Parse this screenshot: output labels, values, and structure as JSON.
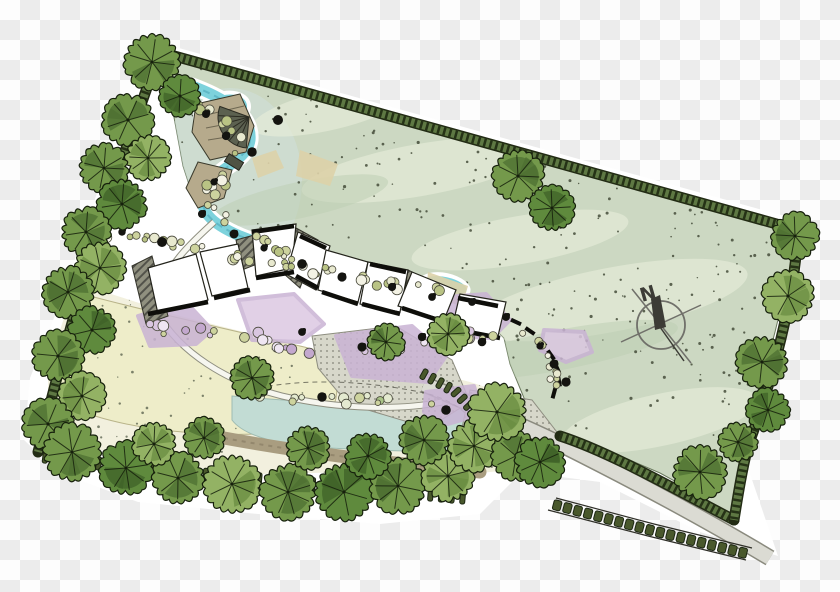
{
  "compass": {
    "label": "N",
    "cx": 661,
    "cy": 325,
    "r": 24,
    "needle": [
      651,
      299,
      660,
      295,
      666,
      327,
      655,
      330
    ],
    "tail": [
      660,
      327,
      684,
      361
    ],
    "cross1": [
      621,
      342,
      701,
      305
    ],
    "cross2": [
      632,
      289,
      691,
      363
    ]
  },
  "palette": {
    "lawn": "#ccd8c2",
    "lawn_wash": "#e7edd9",
    "lawn_wash2": "#bccdb2",
    "speckle": "#3c4431",
    "inner": "#f2f0de",
    "field": "#eeedc9",
    "pond": "#c2dcd4",
    "stream": "#7dd2dc",
    "stream_dark": "#57b2c0",
    "tan": "#b6aa8c",
    "berm": "#a99d80",
    "road_fill": "#dbdbd3",
    "road_edge": "#8a8a7e",
    "band_dark": "#222b14",
    "band_mid": "#5e7843",
    "band_hatch": "#1f2a12",
    "purple": "#c9b3d4",
    "purple_light": "#dcc8e2",
    "wall": "#0e0e0a",
    "building": "#ffffff",
    "building_line": "#23231b",
    "deck": "#5c6150",
    "bridge": "#4f5344",
    "tie_fill": "#49582c",
    "tie_line": "#1c2613",
    "tree_mid": [
      "#74994b",
      "#4d7031"
    ],
    "tree_light": [
      "#93b264",
      "#6a8c42"
    ],
    "tree_dark": [
      "#5f8a3d",
      "#3f6128"
    ],
    "tree_outline": "#16200c",
    "shrub_stroke": "#4a4a3c",
    "blob": "#141410",
    "compass_line": "#70706a",
    "compass_dark": "#3c3c36"
  },
  "halo_path": "M150,40 L806,222 L800,272 L780,342 L760,412 L746,462 L778,556 L700,532 L600,482 L522,472 L480,514 L380,524 L258,514 L138,502 L58,472 L24,440 L30,378 L62,298 L102,178 L140,78 Z",
  "lawn_poly": [
    [
      165,
      55
    ],
    [
      798,
      230
    ],
    [
      792,
      262
    ],
    [
      775,
      332
    ],
    [
      757,
      400
    ],
    [
      744,
      448
    ],
    [
      736,
      492
    ],
    [
      732,
      518
    ],
    [
      702,
      496
    ],
    [
      660,
      473
    ],
    [
      618,
      455
    ],
    [
      582,
      443
    ],
    [
      558,
      436
    ],
    [
      540,
      428
    ],
    [
      524,
      398
    ],
    [
      510,
      364
    ],
    [
      504,
      338
    ],
    [
      482,
      316
    ],
    [
      444,
      298
    ],
    [
      402,
      285
    ],
    [
      352,
      273
    ],
    [
      302,
      261
    ],
    [
      256,
      248
    ],
    [
      216,
      228
    ],
    [
      196,
      206
    ],
    [
      183,
      166
    ],
    [
      173,
      112
    ]
  ],
  "inner_poly": [
    [
      86,
      286
    ],
    [
      180,
      316
    ],
    [
      300,
      346
    ],
    [
      400,
      364
    ],
    [
      470,
      382
    ],
    [
      520,
      398
    ],
    [
      545,
      424
    ],
    [
      543,
      446
    ],
    [
      510,
      470
    ],
    [
      450,
      476
    ],
    [
      360,
      472
    ],
    [
      260,
      474
    ],
    [
      160,
      464
    ],
    [
      84,
      446
    ],
    [
      48,
      416
    ],
    [
      48,
      366
    ],
    [
      64,
      318
    ]
  ],
  "field_path": "M90,296 C150,312 230,330 300,346 C330,352 340,372 336,398 C332,420 300,432 260,434 C200,436 140,430 95,416 C62,404 50,380 58,350 C66,324 76,306 90,296 Z",
  "pond_path": "M232,396 C300,402 380,406 455,406 C492,412 505,424 498,442 C470,454 400,452 330,448 C280,446 244,436 232,420 Z",
  "stream_path": "M192,86 C230,100 252,118 250,140 C247,162 215,168 205,190 C196,210 212,224 240,236 C280,252 330,266 380,277 C410,283 435,286 458,291",
  "stream_pools": [
    [
      222,
      112,
      26,
      16,
      -20
    ],
    [
      300,
      258,
      42,
      11,
      8
    ],
    [
      445,
      286,
      22,
      9,
      12
    ]
  ],
  "blue_wash": [
    230,
    180,
    72,
    92,
    0
  ],
  "sand_patches": [
    "M300,150 L338,164 L330,186 L296,176 Z",
    "M252,158 L276,150 L284,168 L258,178 Z",
    "M428,272 L468,286 L462,306 L426,296 Z"
  ],
  "terraces": [
    "M196,104 L240,94 L254,126 L246,152 L210,160 L192,132 Z",
    "M198,162 L232,170 L224,198 L198,208 L186,188 Z"
  ],
  "terrace_lines": [
    [
      202,
      116,
      244,
      106
    ],
    [
      206,
      128,
      248,
      120
    ],
    [
      208,
      140,
      246,
      134
    ]
  ],
  "fan_deck": {
    "cx": 249,
    "cy": 117,
    "r": 31,
    "a0": 95,
    "a1": 200
  },
  "bridges": [
    [
      234,
      162,
      17,
      9,
      32
    ],
    [
      263,
      247,
      15,
      8,
      18
    ]
  ],
  "roads": [
    "M424,384 C470,404 520,424 560,444 C620,474 700,516 770,558"
  ],
  "walkways": [
    "M158,314 C180,352 226,382 282,396 C342,410 402,410 442,402",
    "M214,222 C192,242 170,262 154,298"
  ],
  "berm": "M224,438 C300,452 380,462 480,472",
  "bed_dash": "M250,390 C300,378 360,380 420,392 C450,398 470,412 478,432",
  "plazas": [
    "M312,336 L396,326 L452,360 L470,402 L428,428 L348,404 L318,368 Z",
    "M470,390 L532,400 L560,436 L540,470 L492,462 L462,428 Z"
  ],
  "band_paths": [
    "M160,52 L798,230",
    "M160,52 C120,160 75,300 38,452",
    "M798,230 C796,280 780,360 748,446",
    "M560,436 C610,452 680,492 734,520",
    "M748,446 C742,470 738,495 734,520"
  ],
  "tie_rows": [
    {
      "pts": [
        [
          40,
          456
        ],
        [
          150,
          470
        ],
        [
          290,
          482
        ],
        [
          468,
          498
        ]
      ],
      "n": 40,
      "w": 5,
      "h": 13
    },
    {
      "pts": [
        [
          552,
          504
        ],
        [
          650,
          530
        ],
        [
          748,
          554
        ]
      ],
      "n": 19,
      "w": 8,
      "h": 10
    },
    {
      "pts": [
        [
          420,
          372
        ],
        [
          456,
          392
        ],
        [
          478,
          416
        ],
        [
          486,
          442
        ]
      ],
      "n": 11,
      "w": 5,
      "h": 11
    }
  ],
  "tie_rails": [
    "M548,510 L648,536 L746,560",
    "M556,498 L654,524 L752,548"
  ],
  "purple_beds": [
    "M138,316 L186,302 L212,330 L196,344 L150,346 Z",
    "M238,300 L294,294 L324,324 L300,342 L252,340 Z",
    "M336,336 L412,326 L446,356 L428,382 L352,376 Z",
    "M432,298 L486,294 L510,320 L492,338 L446,336 Z",
    "M544,330 L584,332 L592,352 L566,362 L540,350 Z",
    "M426,392 L474,386 L482,414 L448,424 L424,412 Z"
  ],
  "buildings": [
    [
      148,
      268,
      196,
      254,
      208,
      300,
      158,
      314
    ],
    [
      200,
      252,
      238,
      244,
      248,
      288,
      212,
      296
    ],
    [
      252,
      230,
      296,
      224,
      292,
      268,
      256,
      276
    ],
    [
      298,
      232,
      330,
      246,
      316,
      290,
      286,
      274
    ],
    [
      326,
      250,
      368,
      262,
      358,
      302,
      318,
      290
    ],
    [
      368,
      262,
      408,
      270,
      400,
      312,
      360,
      304
    ],
    [
      412,
      272,
      456,
      290,
      444,
      320,
      398,
      306
    ],
    [
      460,
      294,
      506,
      302,
      498,
      336,
      452,
      328
    ]
  ],
  "wedges": [
    "M132,266 L152,256 L168,316 L146,324 Z",
    "M296,228 L318,240 L300,288 L284,274 Z",
    "M236,240 L258,234 L262,262 L242,270 Z",
    "M408,270 L432,282 L422,316 L402,308 Z"
  ],
  "walls": [
    [
      148,
      314,
      208,
      302
    ],
    [
      214,
      298,
      250,
      290
    ],
    [
      256,
      278,
      294,
      272
    ],
    [
      296,
      276,
      318,
      288
    ],
    [
      322,
      292,
      358,
      304
    ],
    [
      362,
      304,
      400,
      314
    ],
    [
      402,
      308,
      444,
      322
    ],
    [
      458,
      330,
      500,
      338
    ],
    [
      252,
      232,
      294,
      226
    ],
    [
      300,
      236,
      326,
      248
    ],
    [
      370,
      264,
      406,
      272
    ],
    [
      458,
      298,
      498,
      306
    ]
  ],
  "stepping_stones": [
    [
      516,
      322,
      25
    ],
    [
      530,
      331,
      35
    ],
    [
      542,
      342,
      45
    ],
    [
      551,
      355,
      55
    ],
    [
      557,
      368,
      65
    ],
    [
      559,
      381,
      80
    ],
    [
      554,
      393,
      105
    ]
  ],
  "trees": [
    [
      152,
      62,
      27,
      "m"
    ],
    [
      180,
      96,
      20,
      "d"
    ],
    [
      128,
      120,
      25,
      "m"
    ],
    [
      148,
      158,
      22,
      "l"
    ],
    [
      104,
      168,
      24,
      "m"
    ],
    [
      122,
      204,
      24,
      "d"
    ],
    [
      86,
      232,
      24,
      "m"
    ],
    [
      100,
      268,
      25,
      "l"
    ],
    [
      68,
      292,
      25,
      "m"
    ],
    [
      92,
      330,
      23,
      "d"
    ],
    [
      58,
      356,
      25,
      "m"
    ],
    [
      82,
      396,
      23,
      "l"
    ],
    [
      48,
      424,
      25,
      "m"
    ],
    [
      72,
      452,
      28,
      "m"
    ],
    [
      126,
      468,
      26,
      "d"
    ],
    [
      178,
      478,
      25,
      "m"
    ],
    [
      232,
      484,
      28,
      "l"
    ],
    [
      288,
      492,
      27,
      "m"
    ],
    [
      344,
      492,
      28,
      "d"
    ],
    [
      398,
      486,
      27,
      "m"
    ],
    [
      448,
      476,
      25,
      "l"
    ],
    [
      308,
      448,
      21,
      "m"
    ],
    [
      368,
      456,
      22,
      "d"
    ],
    [
      424,
      440,
      24,
      "m"
    ],
    [
      474,
      446,
      25,
      "l"
    ],
    [
      516,
      456,
      24,
      "m"
    ],
    [
      154,
      444,
      21,
      "l"
    ],
    [
      204,
      438,
      20,
      "m"
    ],
    [
      795,
      236,
      23,
      "m"
    ],
    [
      788,
      296,
      25,
      "l"
    ],
    [
      762,
      362,
      25,
      "m"
    ],
    [
      768,
      410,
      21,
      "d"
    ],
    [
      738,
      442,
      19,
      "m"
    ],
    [
      700,
      472,
      26,
      "m"
    ],
    [
      540,
      462,
      24,
      "d"
    ],
    [
      518,
      176,
      25,
      "m"
    ],
    [
      552,
      208,
      22,
      "d"
    ],
    [
      252,
      378,
      21,
      "m"
    ],
    [
      497,
      412,
      28,
      "l"
    ],
    [
      448,
      334,
      20,
      "l"
    ],
    [
      386,
      342,
      18,
      "m"
    ]
  ],
  "shrub_clusters": [
    {
      "pts": [
        [
          94,
          234
        ],
        [
          150,
          240
        ],
        [
          210,
          250
        ],
        [
          270,
          260
        ],
        [
          330,
          272
        ],
        [
          390,
          282
        ],
        [
          448,
          292
        ]
      ],
      "n": 42,
      "pal": "olive"
    },
    {
      "pts": [
        [
          188,
          102
        ],
        [
          222,
          124
        ],
        [
          246,
          142
        ],
        [
          228,
          168
        ],
        [
          208,
          194
        ],
        [
          218,
          220
        ],
        [
          252,
          238
        ],
        [
          290,
          252
        ]
      ],
      "n": 30,
      "pal": "olive"
    },
    {
      "pts": [
        [
          142,
          328
        ],
        [
          200,
          334
        ],
        [
          258,
          338
        ],
        [
          330,
          356
        ],
        [
          400,
          346
        ],
        [
          460,
          330
        ],
        [
          500,
          342
        ]
      ],
      "n": 40,
      "pal": "purple"
    },
    {
      "pts": [
        [
          520,
          330
        ],
        [
          542,
          350
        ],
        [
          554,
          368
        ],
        [
          556,
          384
        ]
      ],
      "n": 10,
      "pal": "olive"
    },
    {
      "pts": [
        [
          250,
          392
        ],
        [
          310,
          398
        ],
        [
          380,
          402
        ],
        [
          440,
          400
        ]
      ],
      "n": 14,
      "pal": "green"
    }
  ],
  "shrub_palettes": {
    "olive": [
      "#cdd39e",
      "#e8e9cf",
      "#b9c384",
      "#f3f2e4"
    ],
    "purple": [
      "#d9c6e0",
      "#c3a8ce",
      "#efe6f2",
      "#cdd39e"
    ],
    "green": [
      "#a9c387",
      "#cdd39e",
      "#e4ead0"
    ]
  },
  "blobs": [
    [
      206,
      114
    ],
    [
      226,
      136
    ],
    [
      252,
      152
    ],
    [
      214,
      182
    ],
    [
      202,
      214
    ],
    [
      234,
      234
    ],
    [
      264,
      248
    ],
    [
      302,
      264
    ],
    [
      342,
      277
    ],
    [
      392,
      287
    ],
    [
      432,
      297
    ],
    [
      162,
      242
    ],
    [
      122,
      232
    ],
    [
      472,
      302
    ],
    [
      506,
      317
    ],
    [
      540,
      346
    ],
    [
      554,
      364
    ],
    [
      302,
      332
    ],
    [
      362,
      347
    ],
    [
      422,
      337
    ],
    [
      482,
      342
    ],
    [
      262,
      392
    ],
    [
      322,
      397
    ],
    [
      566,
      382
    ],
    [
      446,
      410
    ],
    [
      278,
      120
    ]
  ],
  "washes_light": [
    [
      420,
      170,
      120,
      26,
      -10
    ],
    [
      610,
      300,
      140,
      32,
      -11
    ],
    [
      330,
      110,
      80,
      20,
      -13
    ],
    [
      660,
      420,
      100,
      26,
      -12
    ],
    [
      520,
      240,
      110,
      24,
      -10
    ]
  ],
  "washes_dark": [
    [
      300,
      200,
      90,
      18,
      -12
    ],
    [
      560,
      350,
      120,
      20,
      -11
    ]
  ],
  "speckles": {
    "lawn_n": 520,
    "inner_n": 150,
    "seed": 42
  }
}
